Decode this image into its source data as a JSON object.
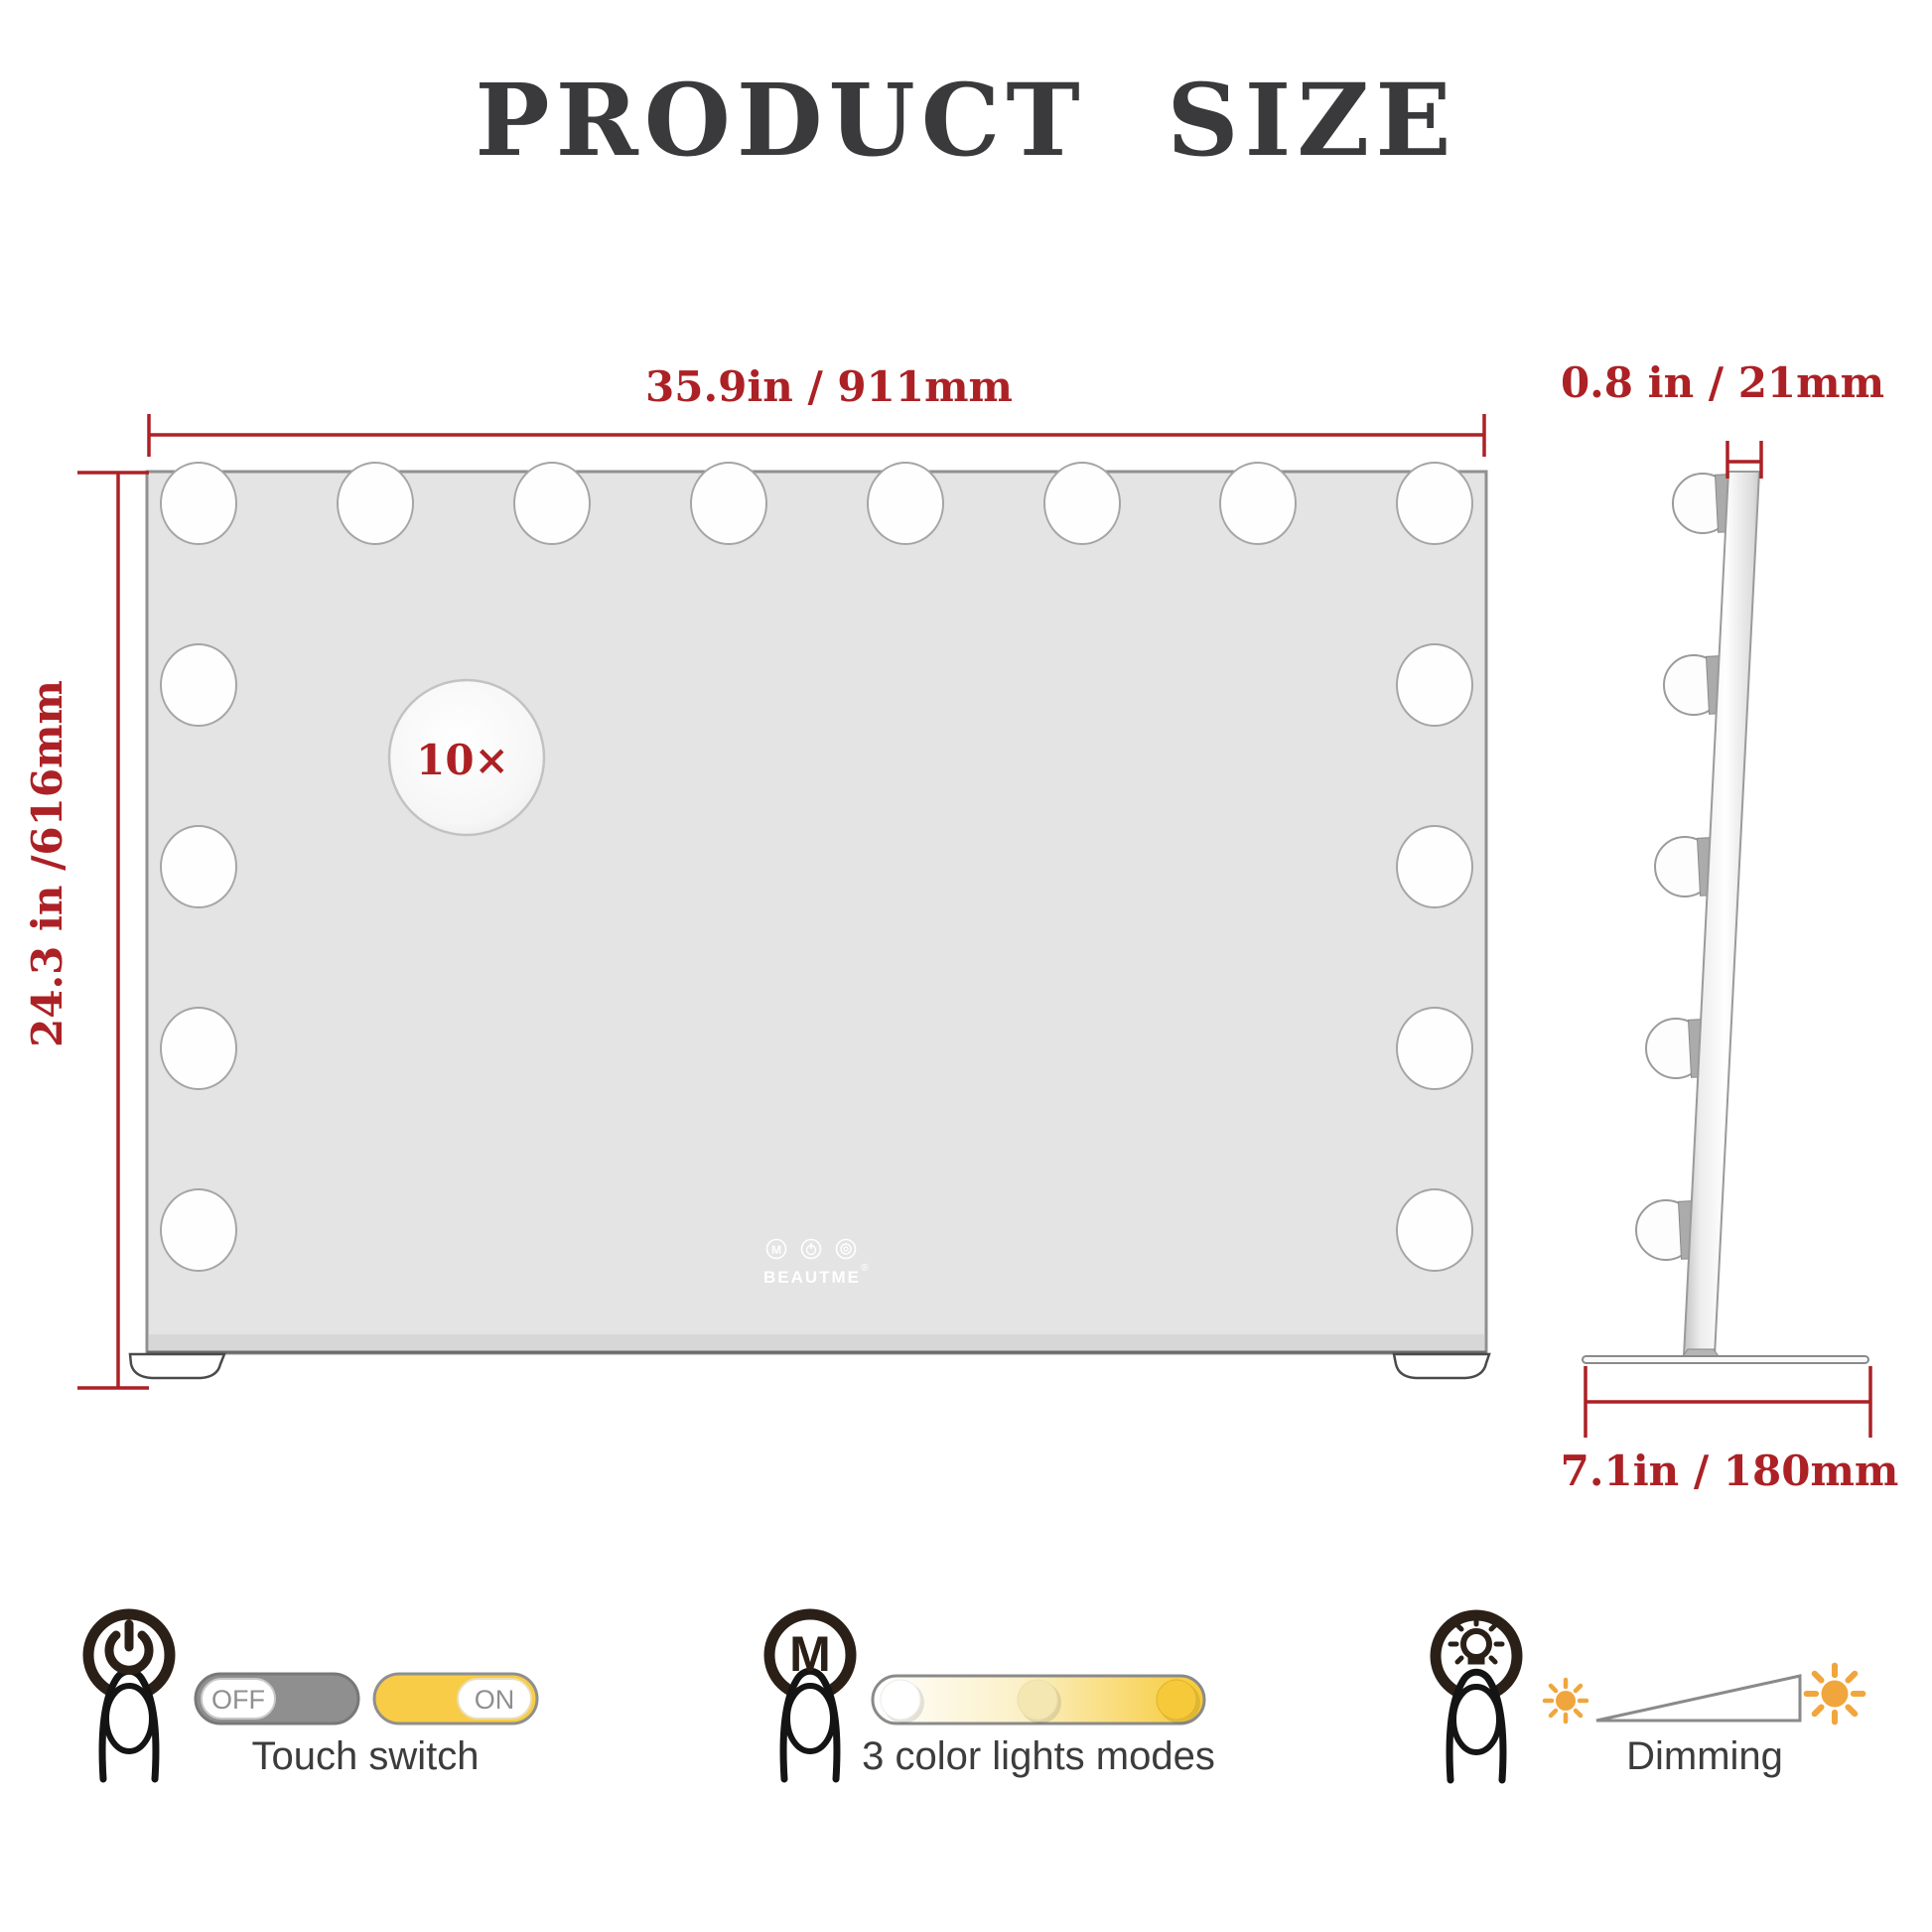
{
  "title": "PRODUCT  SIZE",
  "front": {
    "magnifier_label": "10×",
    "brand": "BEAUTME",
    "brand_reg": "®",
    "mini_m": "M"
  },
  "dims": {
    "width": "35.9in / 911mm",
    "height": "24.3 in /616mm",
    "thickness": "0.8 in / 21mm",
    "base": "7.1in / 180mm"
  },
  "features": {
    "touch": {
      "label": "Touch switch",
      "off": "OFF",
      "on": "ON"
    },
    "modes": {
      "label": "3 color lights modes",
      "m_icon": "M",
      "dots": [
        "#ffffff",
        "#f5e7b2",
        "#f6c93a"
      ]
    },
    "dimming": {
      "label": "Dimming"
    }
  },
  "colors": {
    "accent_red": "#ac2125",
    "mirror_gray": "#e4e4e4",
    "toggle_gray": "#8f8f8f",
    "toggle_yellow": "#f8cc46",
    "sun_orange": "#f0a63c",
    "icon_dark": "#2b2017"
  }
}
